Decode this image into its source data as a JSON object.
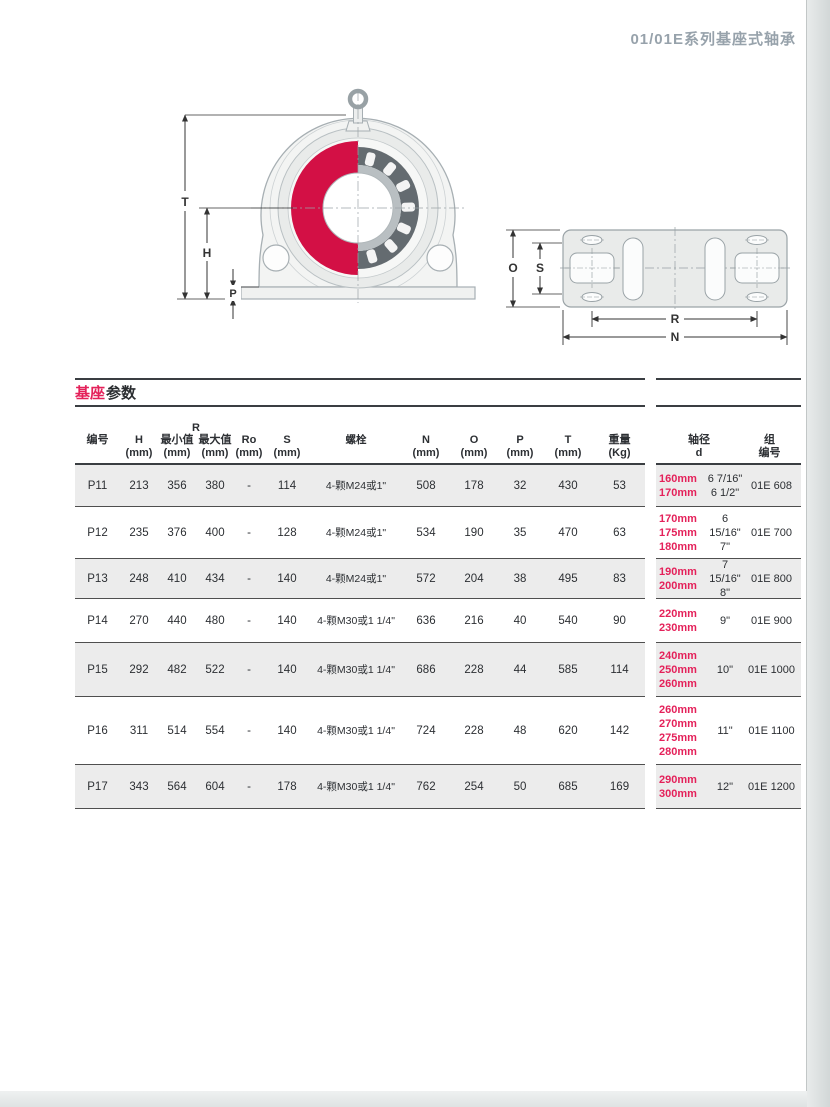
{
  "page": {
    "header_title": "01/01E系列基座式轴承",
    "section_title": {
      "red": "基座",
      "dark": "参数"
    }
  },
  "diagram": {
    "front_labels": {
      "t": "T",
      "h": "H",
      "p": "P"
    },
    "plate_labels": {
      "o": "O",
      "s": "S",
      "r": "R",
      "n": "N"
    }
  },
  "table": {
    "headers": {
      "id": "编号",
      "h": "H",
      "r": "R",
      "r_min": "最小值",
      "r_max": "最大值",
      "ro": "Ro",
      "s": "S",
      "bolt": "螺栓",
      "n": "N",
      "o": "O",
      "p": "P",
      "t": "T",
      "weight": "重量",
      "mm": "(mm)",
      "kg": "(Kg)"
    },
    "rows": [
      {
        "id": "P11",
        "h": "213",
        "r_min": "356",
        "r_max": "380",
        "ro": "-",
        "s": "114",
        "bolt": "4-颗M24或1\"",
        "n": "508",
        "o": "178",
        "p": "32",
        "t": "430",
        "weight": "53"
      },
      {
        "id": "P12",
        "h": "235",
        "r_min": "376",
        "r_max": "400",
        "ro": "-",
        "s": "128",
        "bolt": "4-颗M24或1\"",
        "n": "534",
        "o": "190",
        "p": "35",
        "t": "470",
        "weight": "63"
      },
      {
        "id": "P13",
        "h": "248",
        "r_min": "410",
        "r_max": "434",
        "ro": "-",
        "s": "140",
        "bolt": "4-颗M24或1\"",
        "n": "572",
        "o": "204",
        "p": "38",
        "t": "495",
        "weight": "83"
      },
      {
        "id": "P14",
        "h": "270",
        "r_min": "440",
        "r_max": "480",
        "ro": "-",
        "s": "140",
        "bolt": "4-颗M30或1 1/4\"",
        "n": "636",
        "o": "216",
        "p": "40",
        "t": "540",
        "weight": "90"
      },
      {
        "id": "P15",
        "h": "292",
        "r_min": "482",
        "r_max": "522",
        "ro": "-",
        "s": "140",
        "bolt": "4-颗M30或1 1/4\"",
        "n": "686",
        "o": "228",
        "p": "44",
        "t": "585",
        "weight": "114"
      },
      {
        "id": "P16",
        "h": "311",
        "r_min": "514",
        "r_max": "554",
        "ro": "-",
        "s": "140",
        "bolt": "4-颗M30或1 1/4\"",
        "n": "724",
        "o": "228",
        "p": "48",
        "t": "620",
        "weight": "142"
      },
      {
        "id": "P17",
        "h": "343",
        "r_min": "564",
        "r_max": "604",
        "ro": "-",
        "s": "178",
        "bolt": "4-颗M30或1 1/4\"",
        "n": "762",
        "o": "254",
        "p": "50",
        "t": "685",
        "weight": "169"
      }
    ]
  },
  "shaft_table": {
    "headers": {
      "d1": "轴径",
      "d2": "d",
      "g1": "组",
      "g2": "编号"
    },
    "rows": [
      {
        "mm": "160mm\n170mm",
        "inch": "6 7/16\"\n6 1/2\"",
        "group": "01E 608"
      },
      {
        "mm": "170mm\n175mm\n180mm",
        "inch": "6\n15/16\"\n7\"",
        "group": "01E 700"
      },
      {
        "mm": "190mm\n200mm",
        "inch": "7 15/16\"\n8\"",
        "group": "01E 800"
      },
      {
        "mm": "220mm\n230mm",
        "inch": "9\"",
        "group": "01E 900"
      },
      {
        "mm": "240mm\n250mm\n260mm",
        "inch": "10\"",
        "group": "01E 1000"
      },
      {
        "mm": "260mm\n270mm\n275mm\n280mm",
        "inch": "11\"",
        "group": "01E 1100"
      },
      {
        "mm": "290mm\n300mm",
        "inch": "12\"",
        "group": "01E 1200"
      }
    ]
  },
  "colors": {
    "accent": "#e4215a",
    "bearing_red": "#d31045",
    "header_gray": "#97a2ab",
    "shade": "#ececec",
    "line": "#4f4f4f"
  }
}
